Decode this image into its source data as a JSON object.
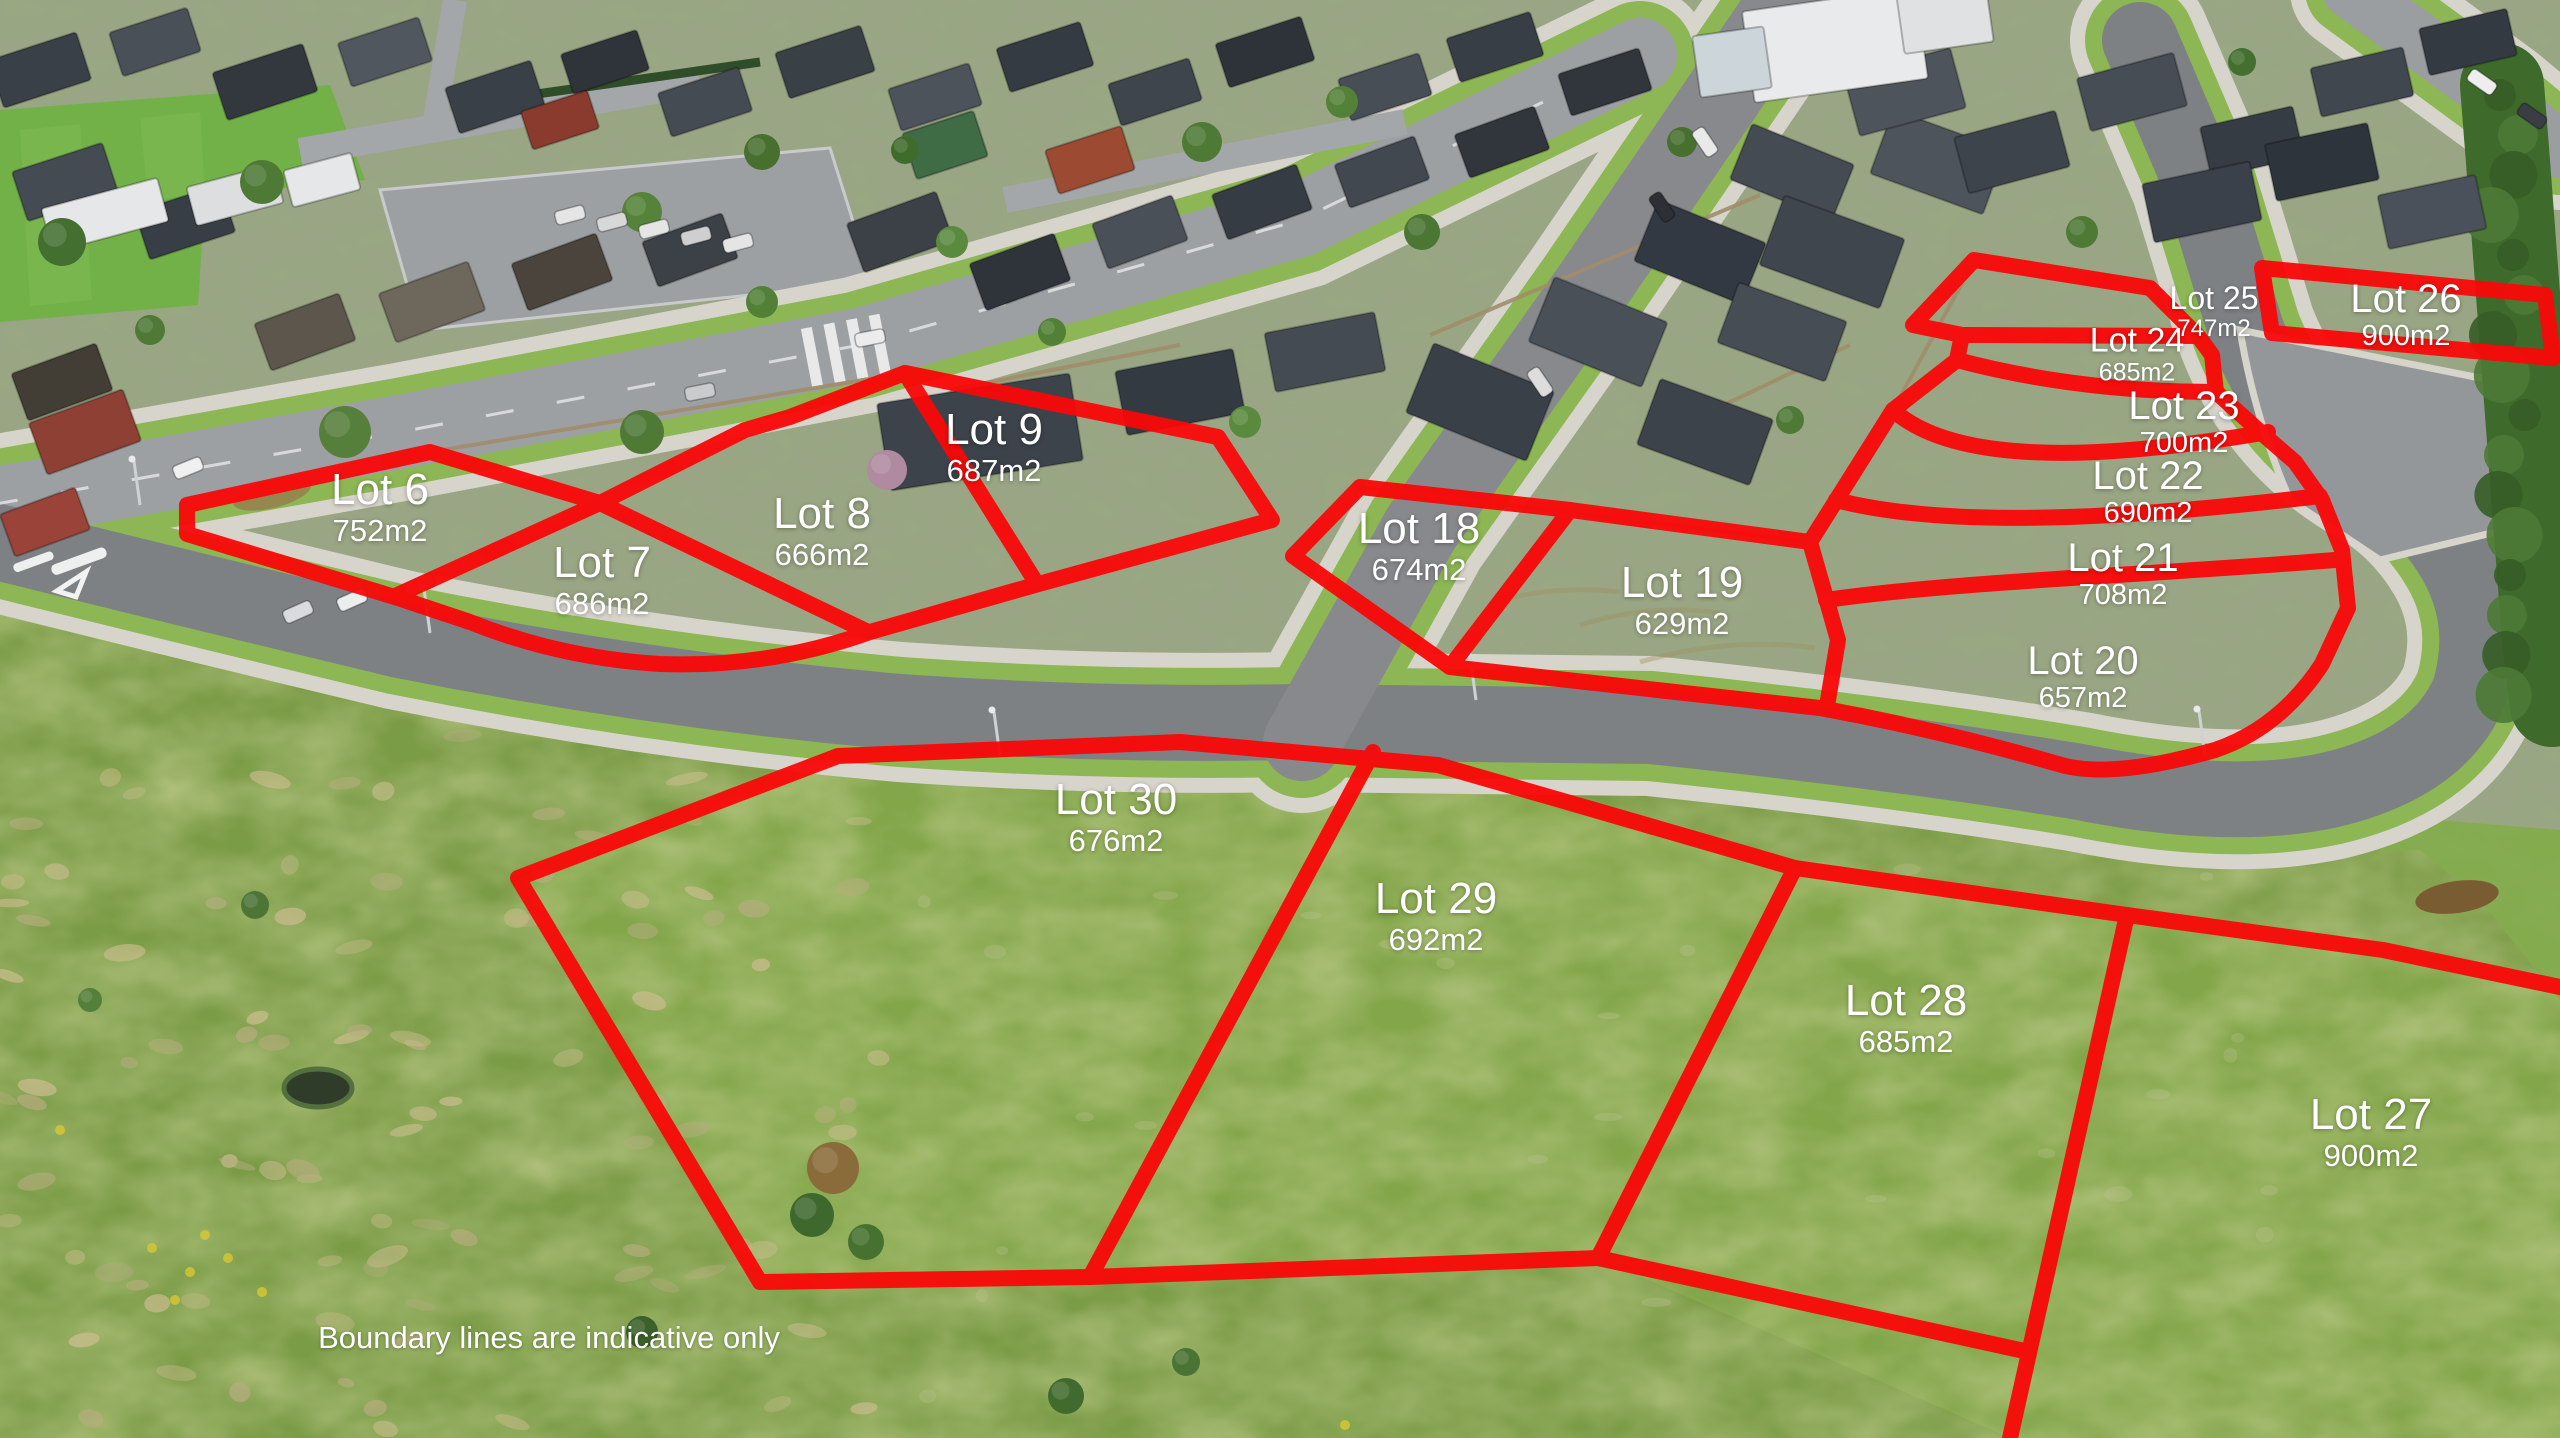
{
  "overlay": {
    "boundary_color": "#f90808",
    "label_color": "#ffffff",
    "disclaimer": "Boundary lines are indicative only"
  },
  "lots": [
    {
      "id": "lot-6",
      "name": "Lot 6",
      "area": "752m2"
    },
    {
      "id": "lot-7",
      "name": "Lot 7",
      "area": "686m2"
    },
    {
      "id": "lot-8",
      "name": "Lot 8",
      "area": "666m2"
    },
    {
      "id": "lot-9",
      "name": "Lot 9",
      "area": "687m2"
    },
    {
      "id": "lot-18",
      "name": "Lot 18",
      "area": "674m2"
    },
    {
      "id": "lot-19",
      "name": "Lot 19",
      "area": "629m2"
    },
    {
      "id": "lot-20",
      "name": "Lot 20",
      "area": "657m2"
    },
    {
      "id": "lot-21",
      "name": "Lot 21",
      "area": "708m2"
    },
    {
      "id": "lot-22",
      "name": "Lot 22",
      "area": "690m2"
    },
    {
      "id": "lot-23",
      "name": "Lot 23",
      "area": "700m2"
    },
    {
      "id": "lot-24",
      "name": "Lot 24",
      "area": "685m2"
    },
    {
      "id": "lot-25",
      "name": "Lot 25",
      "area": "747m2"
    },
    {
      "id": "lot-26",
      "name": "Lot 26",
      "area": "900m2"
    },
    {
      "id": "lot-27",
      "name": "Lot 27",
      "area": "900m2"
    },
    {
      "id": "lot-28",
      "name": "Lot 28",
      "area": "685m2"
    },
    {
      "id": "lot-29",
      "name": "Lot 29",
      "area": "692m2"
    },
    {
      "id": "lot-30",
      "name": "Lot 30",
      "area": "676m2"
    }
  ]
}
